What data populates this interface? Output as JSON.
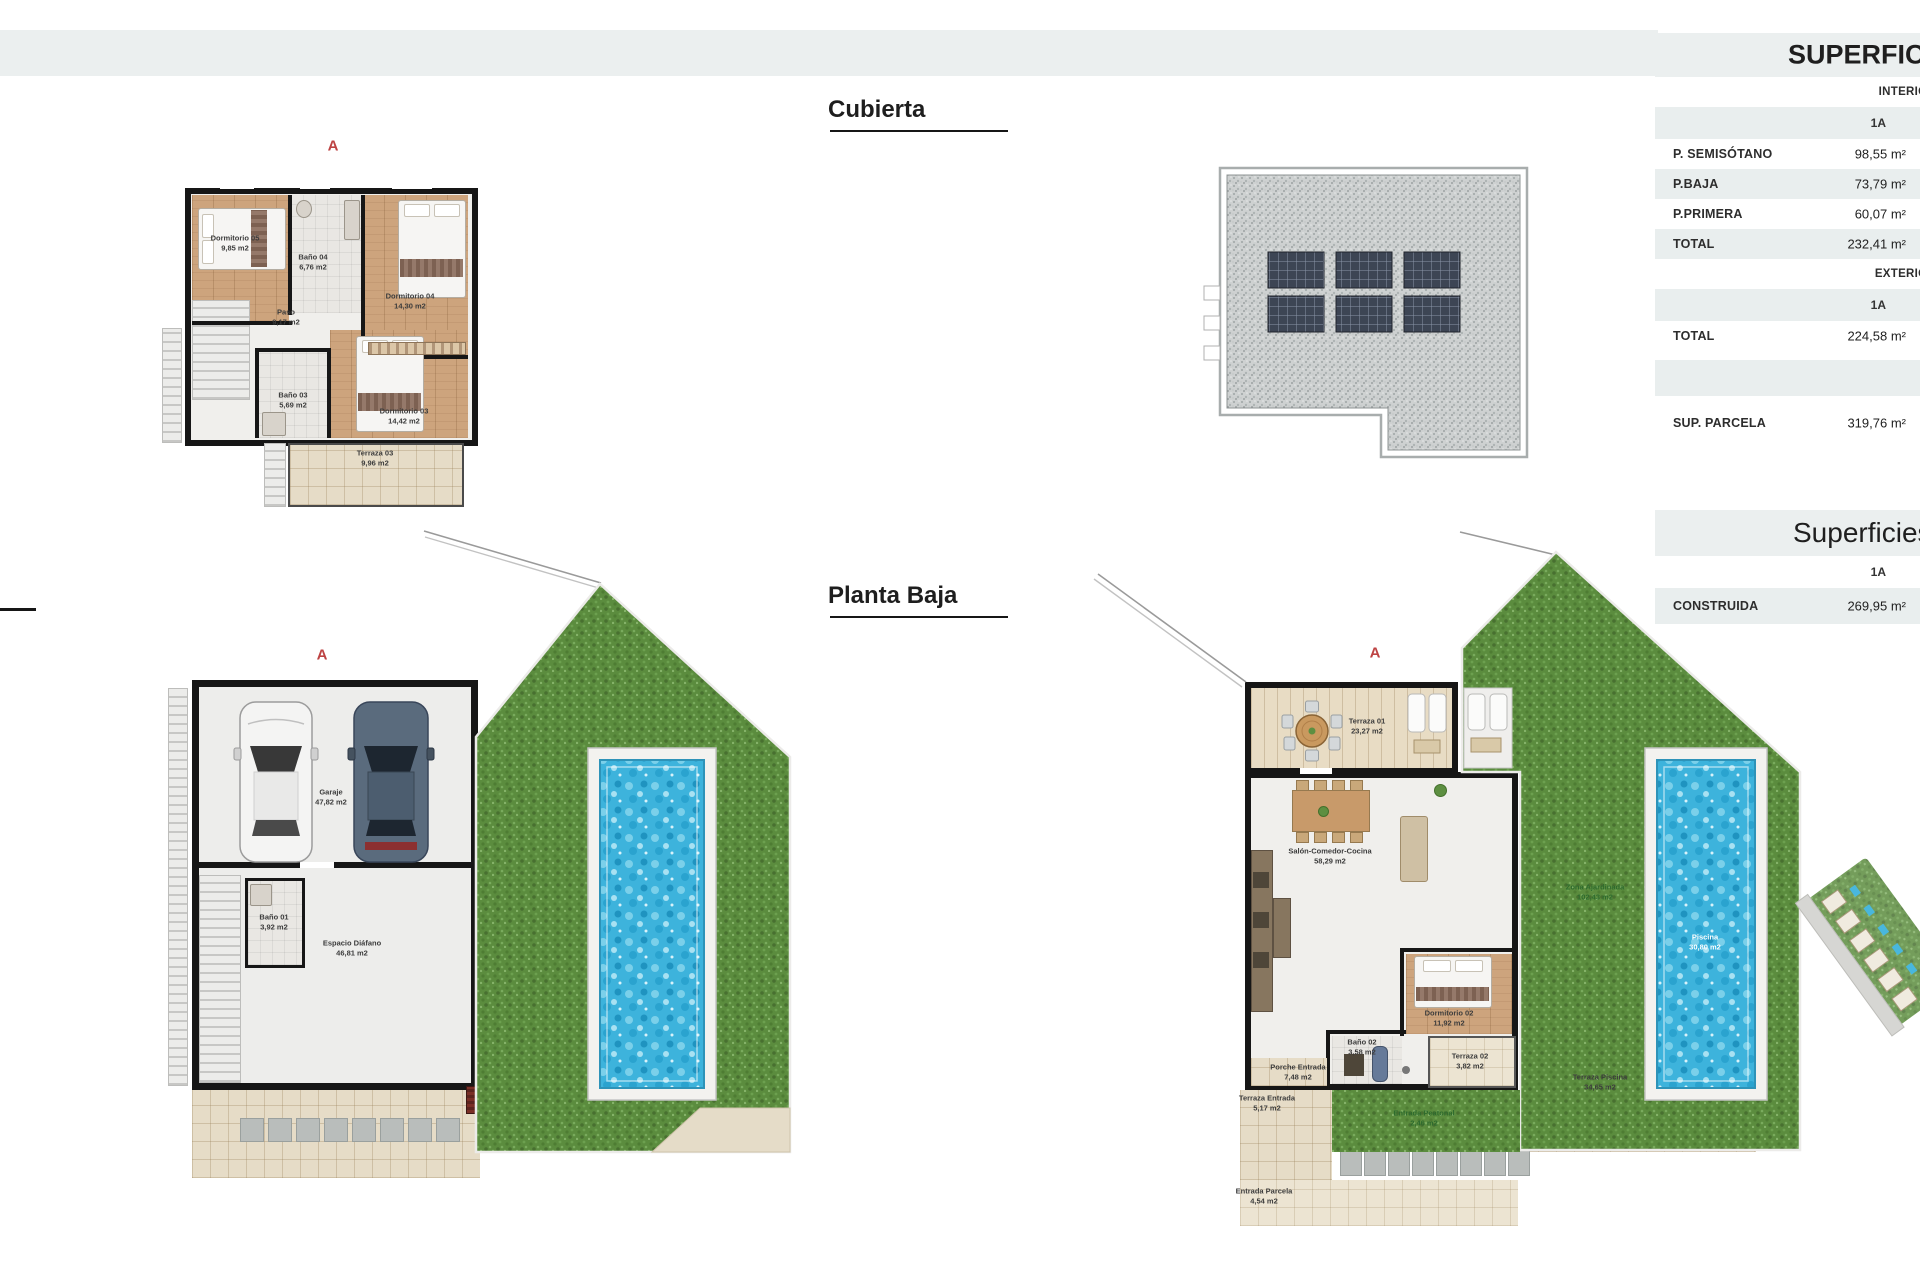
{
  "section_marker": "A",
  "titles": {
    "roof": "Cubierta",
    "ground": "Planta Baja"
  },
  "area_table": {
    "title": "SUPERFICIES",
    "interior_header": "INTERIOR",
    "exterior_header": "EXTERIOR",
    "unit": "1A",
    "interior_rows": [
      {
        "label": "P. SEMISÓTANO",
        "value": "98,55 m²"
      },
      {
        "label": "P.BAJA",
        "value": "73,79 m²"
      },
      {
        "label": "P.PRIMERA",
        "value": "60,07 m²"
      },
      {
        "label": "TOTAL",
        "value": "232,41 m²"
      }
    ],
    "exterior_rows": [
      {
        "label": "TOTAL",
        "value": "224,58 m²"
      }
    ],
    "parcel_row": {
      "label": "SUP. PARCELA",
      "value": "319,76 m²"
    }
  },
  "built_table": {
    "title": "Superficies",
    "unit": "1A",
    "rows": [
      {
        "label": "CONSTRUIDA",
        "value": "269,95 m²"
      }
    ]
  },
  "plans": {
    "first_floor": {
      "marker": "A",
      "rooms": [
        {
          "name": "Dormitorio 05",
          "area": "9,85 m2"
        },
        {
          "name": "Baño 04",
          "area": "6,76 m2"
        },
        {
          "name": "Dormitorio 04",
          "area": "14,30 m2"
        },
        {
          "name": "Paso",
          "area": "9,17 m2"
        },
        {
          "name": "Baño 03",
          "area": "5,69 m2"
        },
        {
          "name": "Dormitorio 03",
          "area": "14,42 m2"
        },
        {
          "name": "Terraza 03",
          "area": "9,96 m2"
        }
      ]
    },
    "basement": {
      "marker": "A",
      "rooms": [
        {
          "name": "Garaje",
          "area": "47,82 m2"
        },
        {
          "name": "Baño 01",
          "area": "3,92 m2"
        },
        {
          "name": "Espacio Diáfano",
          "area": "46,81 m2"
        }
      ]
    },
    "ground_floor": {
      "marker": "A",
      "rooms": [
        {
          "name": "Terraza 01",
          "area": "23,27 m2"
        },
        {
          "name": "Salón-Comedor-Cocina",
          "area": "58,29 m2"
        },
        {
          "name": "Dormitorio 02",
          "area": "11,92 m2"
        },
        {
          "name": "Baño 02",
          "area": "3,58 m2"
        },
        {
          "name": "Terraza 02",
          "area": "3,82 m2"
        },
        {
          "name": "Porche Entrada",
          "area": "7,48 m2"
        },
        {
          "name": "Terraza Entrada",
          "area": "5,17 m2"
        },
        {
          "name": "Entrada Parcela",
          "area": "4,54 m2"
        },
        {
          "name": "Entrada Peatonal",
          "area": "2,46 m2"
        },
        {
          "name": "Terraza Piscina",
          "area": "34,65 m2"
        },
        {
          "name": "Piscina",
          "area": "30,80 m2"
        },
        {
          "name": "Zona Ajardinada",
          "area": "102,43 m2"
        }
      ]
    }
  }
}
